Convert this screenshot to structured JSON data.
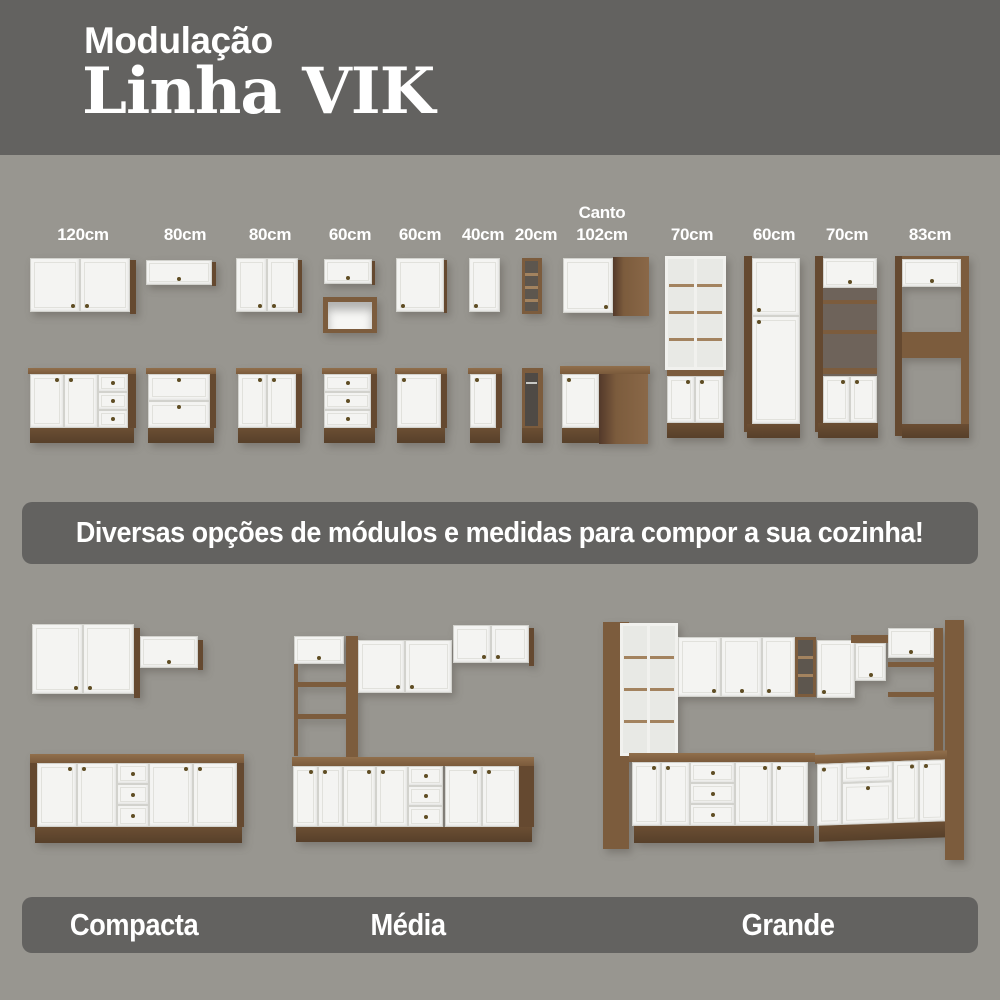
{
  "header": {
    "subtitle": "Modulação",
    "title": "Linha VIK"
  },
  "modules": {
    "canto_prefix": "Canto",
    "labels": [
      "120cm",
      "80cm",
      "80cm",
      "60cm",
      "60cm",
      "40cm",
      "20cm",
      "102cm",
      "70cm",
      "60cm",
      "70cm",
      "83cm"
    ]
  },
  "middle_banner": {
    "text": "Diversas opções de módulos e medidas para compor a sua cozinha!"
  },
  "kitchens": {
    "labels": [
      "Compacta",
      "Média",
      "Grande"
    ]
  },
  "colors": {
    "background": "#989690",
    "banner": "#636260",
    "text": "#ffffff",
    "wood": "#7c5c3d",
    "wood_dark": "#5f452c",
    "door_white": "#f4f4f2"
  }
}
